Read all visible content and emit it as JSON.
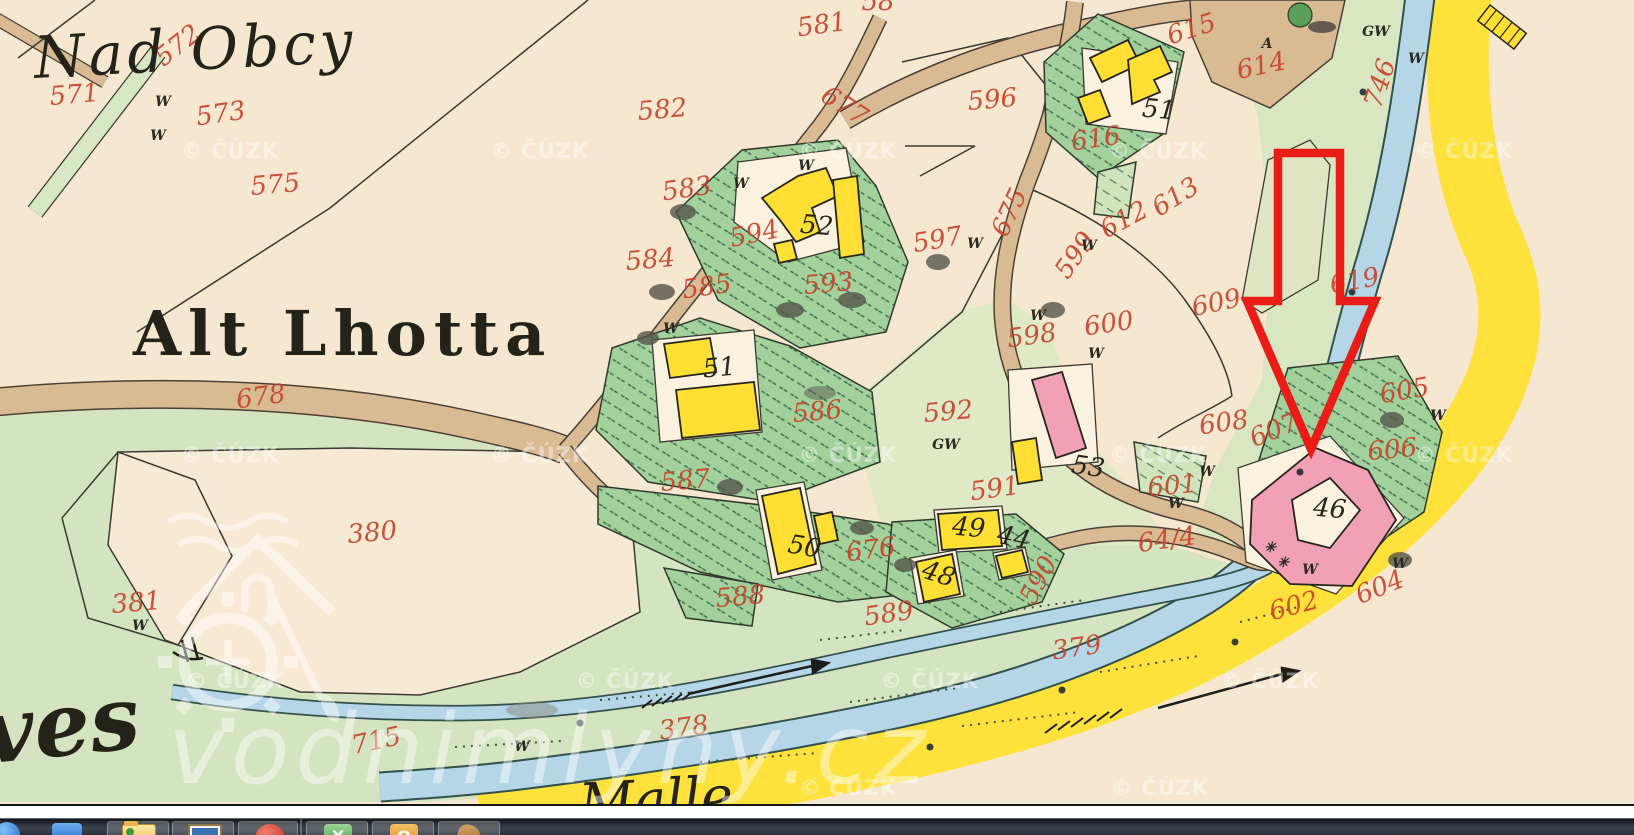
{
  "map": {
    "place_labels": {
      "nad_obcy": "Nad Obcy",
      "alt_lhotta": "Alt Lhotta",
      "ves_fragment": "ves",
      "river_name_fragment": "Malle"
    },
    "parcel_numbers": [
      {
        "text": "571",
        "x": 75,
        "y": 103,
        "rot": -5
      },
      {
        "text": "572",
        "x": 183,
        "y": 52,
        "rot": -38,
        "size": 23
      },
      {
        "text": "573",
        "x": 222,
        "y": 122,
        "rot": -8
      },
      {
        "text": "575",
        "x": 276,
        "y": 193,
        "rot": -5
      },
      {
        "text": "582",
        "x": 663,
        "y": 118,
        "rot": -5,
        "size": 30
      },
      {
        "text": "581",
        "x": 823,
        "y": 33,
        "rot": -8
      },
      {
        "text": "58",
        "x": 878,
        "y": 10,
        "rot": 0,
        "size": 24
      },
      {
        "text": "677",
        "x": 840,
        "y": 113,
        "rot": 33
      },
      {
        "text": "596",
        "x": 993,
        "y": 108,
        "rot": -5,
        "size": 30
      },
      {
        "text": "615",
        "x": 1194,
        "y": 37,
        "rot": -18
      },
      {
        "text": "614",
        "x": 1263,
        "y": 74,
        "rot": -12
      },
      {
        "text": "616",
        "x": 1097,
        "y": 147,
        "rot": -8
      },
      {
        "text": "612",
        "x": 1128,
        "y": 227,
        "rot": -28
      },
      {
        "text": "613",
        "x": 1180,
        "y": 204,
        "rot": -32
      },
      {
        "text": "619",
        "x": 1356,
        "y": 289,
        "rot": -10
      },
      {
        "text": "600",
        "x": 1110,
        "y": 332,
        "rot": -8
      },
      {
        "text": "609",
        "x": 1218,
        "y": 311,
        "rot": -12,
        "size": 30
      },
      {
        "text": "608",
        "x": 1225,
        "y": 431,
        "rot": -8,
        "size": 28
      },
      {
        "text": "607",
        "x": 1277,
        "y": 438,
        "rot": -22
      },
      {
        "text": "605",
        "x": 1406,
        "y": 399,
        "rot": -10
      },
      {
        "text": "606",
        "x": 1393,
        "y": 458,
        "rot": -5
      },
      {
        "text": "601",
        "x": 1173,
        "y": 494,
        "rot": -5
      },
      {
        "text": "64/4",
        "x": 1168,
        "y": 548,
        "rot": -8
      },
      {
        "text": "604",
        "x": 1383,
        "y": 595,
        "rot": -22
      },
      {
        "text": "602",
        "x": 1296,
        "y": 614,
        "rot": -15
      },
      {
        "text": "592",
        "x": 949,
        "y": 420,
        "rot": -5,
        "size": 29
      },
      {
        "text": "598",
        "x": 1033,
        "y": 344,
        "rot": -8
      },
      {
        "text": "599",
        "x": 1082,
        "y": 260,
        "rot": -55
      },
      {
        "text": "675",
        "x": 1017,
        "y": 216,
        "rot": -65
      },
      {
        "text": "597",
        "x": 939,
        "y": 248,
        "rot": -10
      },
      {
        "text": "593",
        "x": 829,
        "y": 292,
        "rot": -5
      },
      {
        "text": "594",
        "x": 756,
        "y": 242,
        "rot": -12
      },
      {
        "text": "583",
        "x": 688,
        "y": 197,
        "rot": -8
      },
      {
        "text": "584",
        "x": 651,
        "y": 268,
        "rot": -5
      },
      {
        "text": "585",
        "x": 708,
        "y": 295,
        "rot": -8
      },
      {
        "text": "586",
        "x": 818,
        "y": 420,
        "rot": -5,
        "size": 30
      },
      {
        "text": "587",
        "x": 686,
        "y": 489,
        "rot": -5,
        "size": 29
      },
      {
        "text": "591",
        "x": 996,
        "y": 497,
        "rot": -8
      },
      {
        "text": "590",
        "x": 1046,
        "y": 584,
        "rot": -62
      },
      {
        "text": "589",
        "x": 890,
        "y": 622,
        "rot": -8,
        "size": 28
      },
      {
        "text": "588",
        "x": 741,
        "y": 605,
        "rot": -5,
        "size": 28
      },
      {
        "text": "676",
        "x": 872,
        "y": 558,
        "rot": -8,
        "size": 28
      },
      {
        "text": "678",
        "x": 262,
        "y": 405,
        "rot": -8,
        "size": 29
      },
      {
        "text": "380",
        "x": 373,
        "y": 541,
        "rot": -5,
        "size": 29
      },
      {
        "text": "381",
        "x": 137,
        "y": 611,
        "rot": -5
      },
      {
        "text": "715",
        "x": 378,
        "y": 749,
        "rot": -12
      },
      {
        "text": "378",
        "x": 685,
        "y": 736,
        "rot": -8,
        "size": 29
      },
      {
        "text": "379",
        "x": 1078,
        "y": 656,
        "rot": -8,
        "size": 31
      },
      {
        "text": "746",
        "x": 1388,
        "y": 86,
        "rot": -72
      }
    ],
    "building_numbers": [
      {
        "text": "52",
        "x": 816,
        "y": 234,
        "rot": 5
      },
      {
        "text": "51",
        "x": 1158,
        "y": 118,
        "rot": 5
      },
      {
        "text": "51",
        "x": 720,
        "y": 376,
        "rot": -5
      },
      {
        "text": "53",
        "x": 1087,
        "y": 475,
        "rot": 8
      },
      {
        "text": "50",
        "x": 803,
        "y": 555,
        "rot": 10,
        "size": 21
      },
      {
        "text": "49",
        "x": 968,
        "y": 536,
        "rot": 5
      },
      {
        "text": "48",
        "x": 936,
        "y": 582,
        "rot": 18,
        "size": 23
      },
      {
        "text": "44",
        "x": 1012,
        "y": 546,
        "rot": 12,
        "size": 19
      },
      {
        "text": "46",
        "x": 1329,
        "y": 517,
        "rot": 5
      }
    ],
    "letter_marks": [
      {
        "text": "W",
        "x": 163,
        "y": 106
      },
      {
        "text": "W",
        "x": 158,
        "y": 140
      },
      {
        "text": "W",
        "x": 741,
        "y": 188
      },
      {
        "text": "W",
        "x": 806,
        "y": 170
      },
      {
        "text": "W",
        "x": 671,
        "y": 333
      },
      {
        "text": "W",
        "x": 975,
        "y": 248
      },
      {
        "text": "W",
        "x": 1089,
        "y": 250
      },
      {
        "text": "W",
        "x": 1038,
        "y": 320
      },
      {
        "text": "W",
        "x": 1096,
        "y": 358
      },
      {
        "text": "W",
        "x": 1416,
        "y": 63
      },
      {
        "text": "W",
        "x": 1176,
        "y": 508
      },
      {
        "text": "W",
        "x": 1207,
        "y": 476
      },
      {
        "text": "W",
        "x": 1438,
        "y": 420
      },
      {
        "text": "W",
        "x": 1400,
        "y": 568
      },
      {
        "text": "W",
        "x": 140,
        "y": 630
      },
      {
        "text": "W",
        "x": 522,
        "y": 751
      },
      {
        "text": "W",
        "x": 1310,
        "y": 574
      },
      {
        "text": "GW",
        "x": 1376,
        "y": 36,
        "size": 17
      },
      {
        "text": "GW",
        "x": 946,
        "y": 449,
        "size": 17
      },
      {
        "text": "A",
        "x": 1267,
        "y": 48,
        "size": 15
      },
      {
        "text": "✳",
        "x": 1270,
        "y": 552,
        "size": 13
      },
      {
        "text": "✳",
        "x": 1283,
        "y": 567,
        "size": 13
      }
    ],
    "watermarks": {
      "copyright": "© ČÚZK",
      "site": "vodnimlyny.cz",
      "copyright_stamps": [
        {
          "text": "© ČÚZK",
          "x": 230,
          "y": 158
        },
        {
          "text": "© ČÚZK",
          "x": 540,
          "y": 158
        },
        {
          "text": "© ČÚZK",
          "x": 848,
          "y": 158
        },
        {
          "text": "© ČÚZK",
          "x": 1158,
          "y": 158
        },
        {
          "text": "© ČÚZK",
          "x": 1464,
          "y": 158
        },
        {
          "text": "© ČÚZK",
          "x": 230,
          "y": 462
        },
        {
          "text": "© ČÚZK",
          "x": 540,
          "y": 462
        },
        {
          "text": "© ČÚZK",
          "x": 848,
          "y": 462
        },
        {
          "text": "© ČÚZK",
          "x": 1158,
          "y": 462
        },
        {
          "text": "© ČÚZK",
          "x": 1464,
          "y": 462
        },
        {
          "text": "© ČÚZK",
          "x": 235,
          "y": 688
        },
        {
          "text": "© ČÚZK",
          "x": 625,
          "y": 688
        },
        {
          "text": "© ČÚZK",
          "x": 930,
          "y": 688
        },
        {
          "text": "© ČÚZK",
          "x": 1270,
          "y": 688
        },
        {
          "text": "© ČÚZK",
          "x": 848,
          "y": 795
        },
        {
          "text": "© ČÚZK",
          "x": 1160,
          "y": 795
        }
      ]
    },
    "annotation": {
      "type": "arrow",
      "color": "#ea1c17"
    }
  },
  "taskbar": {
    "icons": [
      {
        "name": "internet-explorer-icon"
      },
      {
        "name": "blue-app-icon"
      },
      {
        "name": "folder-icon"
      },
      {
        "name": "image-viewer-icon"
      },
      {
        "name": "red-record-icon"
      },
      {
        "name": "excel-icon"
      },
      {
        "name": "powerpoint-icon"
      },
      {
        "name": "document-icon"
      }
    ]
  }
}
